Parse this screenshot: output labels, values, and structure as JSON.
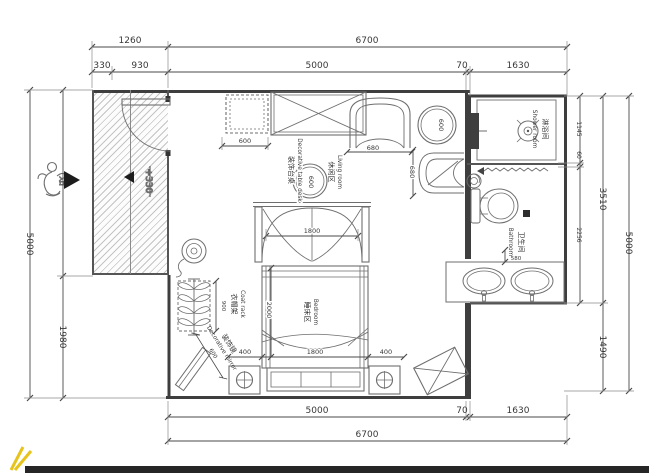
{
  "colors": {
    "wall": "#3e3e3e",
    "furniture_line": "#6e6e6e",
    "dim_line": "#4a4a4a",
    "hatch": "#c4c4c4",
    "watermark_yellow": "#e6c41c",
    "bottom_bar": "#262626"
  },
  "rooms": {
    "living": {
      "zh": "休闲区",
      "en": "Living room"
    },
    "bedroom": {
      "zh": "睡床区",
      "en": "Bedroom"
    },
    "shower": {
      "zh": "淋浴间",
      "en": "Shower room"
    },
    "bathroom": {
      "zh": "卫生间",
      "en": "Bathroom"
    }
  },
  "labels": {
    "coat_rack": {
      "zh": "衣帽架",
      "en": "Coat rack",
      "dim": "900"
    },
    "mirror": {
      "zh": "装饰镜",
      "en": "Decorative mirror",
      "dim": "600"
    },
    "deco_table": {
      "zh": "装饰台桌",
      "en": "Decorative table desk",
      "dim": "600"
    },
    "entry": "入口",
    "floor_level": "+330"
  },
  "dims": {
    "t1260": "1260",
    "t6700": "6700",
    "t330": "330",
    "t930": "930",
    "t5000": "5000",
    "t70": "70",
    "t1630": "1630",
    "b5000": "5000",
    "b70": "70",
    "b1630": "1630",
    "b6700": "6700",
    "l5000": "5000",
    "l1980": "1980",
    "r1145": "1145",
    "r60": "60",
    "r2256": "2256",
    "r3510": "3510",
    "r1490": "1490",
    "r5000": "5000",
    "cabinet": "600",
    "chair_a": "680",
    "chair_b": "680",
    "round_table": "600",
    "canopy": "1800",
    "bed_len": "2000",
    "bed_w": "1800",
    "side_l": "400",
    "side_r": "400",
    "vanity": "580"
  }
}
